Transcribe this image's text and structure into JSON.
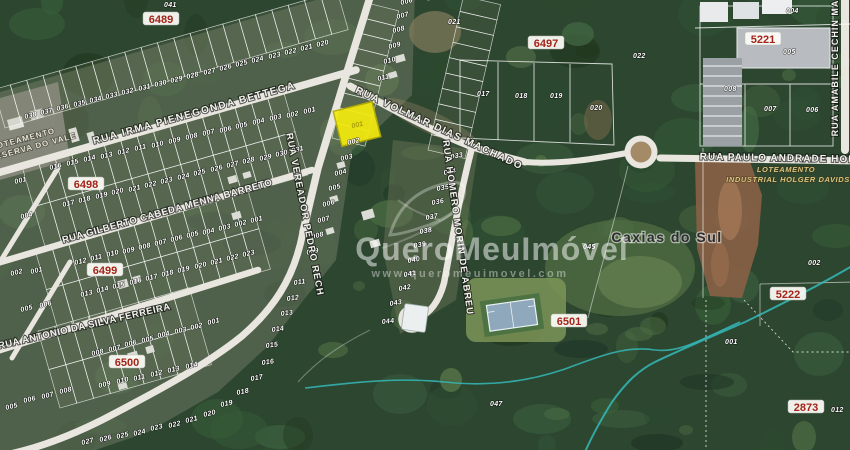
{
  "map": {
    "city_label": "Caxias do Sul",
    "watermark": {
      "brand": "QueroMeuImóvel",
      "url": "www.queromeuimovel.com"
    },
    "colors": {
      "highlight": "#f3ea0e",
      "road": "#e8e6df",
      "stream": "#35b8b8",
      "badge_text": "#a3241a",
      "forest_base": "#2d4630"
    },
    "areas": {
      "left_line1": "LOTEAMENTO",
      "left_line2": "RESERVA DO VALE",
      "right_line1": "LOTEAMENTO",
      "right_line2": "INDUSTRIAL HOLGER DAVIDS"
    },
    "highlight": {
      "lot": "001",
      "x": 357,
      "y": 124
    },
    "streets": [
      {
        "label": "RUA IRMA PIENEGONDA BETTEGA",
        "x": 195,
        "y": 116,
        "r": -15.5,
        "fs": 10,
        "ls": 1.5
      },
      {
        "label": "RUA VOLMAR DIAS MACHADO",
        "x": 438,
        "y": 131,
        "r": 25,
        "fs": 10,
        "ls": 1.5
      },
      {
        "label": "RUA VEREADOR PEDRO RECH",
        "x": 302,
        "y": 215,
        "r": 79,
        "fs": 9.5,
        "ls": 1
      },
      {
        "label": "RUA HOMERO MORIN DE ABREU",
        "x": 455,
        "y": 228,
        "r": 82,
        "fs": 9.5,
        "ls": 1
      },
      {
        "label": "RUA GILBERTO CABEDA MENNA BARRETO",
        "x": 168,
        "y": 214,
        "r": -15.5,
        "fs": 9.5,
        "ls": 0.5
      },
      {
        "label": "RUA ANTONIO DA SILVA FERREIRA",
        "x": 85,
        "y": 329,
        "r": -13,
        "fs": 9.5,
        "ls": 0.5
      },
      {
        "label": "RUA PAULO ANDRADE HON",
        "x": 778,
        "y": 161,
        "r": 1,
        "fs": 10,
        "ls": 1
      },
      {
        "label": "RUA AMABILE CECHIN MA",
        "x": 838,
        "y": 68,
        "r": -90,
        "fs": 9,
        "ls": 1
      }
    ],
    "blocks": [
      {
        "label": "6489",
        "x": 161,
        "y": 22
      },
      {
        "label": "6497",
        "x": 546,
        "y": 46
      },
      {
        "label": "5221",
        "x": 763,
        "y": 42
      },
      {
        "label": "6498",
        "x": 86,
        "y": 187
      },
      {
        "label": "6499",
        "x": 105,
        "y": 273
      },
      {
        "label": "6500",
        "x": 127,
        "y": 365
      },
      {
        "label": "6501",
        "x": 569,
        "y": 324
      },
      {
        "label": "5222",
        "x": 788,
        "y": 297
      },
      {
        "label": "2873",
        "x": 806,
        "y": 410
      }
    ],
    "lot_labels": [
      {
        "t": "041",
        "x": 164,
        "y": 7,
        "r": 0
      },
      {
        "t": "038",
        "x": 25,
        "y": 119
      },
      {
        "t": "037",
        "x": 41,
        "y": 115
      },
      {
        "t": "036",
        "x": 57,
        "y": 111
      },
      {
        "t": "035",
        "x": 74,
        "y": 107
      },
      {
        "t": "034",
        "x": 90,
        "y": 103
      },
      {
        "t": "033",
        "x": 106,
        "y": 99
      },
      {
        "t": "032",
        "x": 122,
        "y": 95
      },
      {
        "t": "031",
        "x": 139,
        "y": 91
      },
      {
        "t": "030",
        "x": 155,
        "y": 87
      },
      {
        "t": "029",
        "x": 171,
        "y": 83
      },
      {
        "t": "028",
        "x": 187,
        "y": 79
      },
      {
        "t": "027",
        "x": 204,
        "y": 75
      },
      {
        "t": "026",
        "x": 220,
        "y": 71
      },
      {
        "t": "025",
        "x": 236,
        "y": 67
      },
      {
        "t": "024",
        "x": 252,
        "y": 63
      },
      {
        "t": "023",
        "x": 269,
        "y": 59
      },
      {
        "t": "022",
        "x": 285,
        "y": 55
      },
      {
        "t": "021",
        "x": 301,
        "y": 51
      },
      {
        "t": "020",
        "x": 317,
        "y": 47
      },
      {
        "t": "001",
        "x": 304,
        "y": 114
      },
      {
        "t": "002",
        "x": 287,
        "y": 118
      },
      {
        "t": "003",
        "x": 270,
        "y": 121
      },
      {
        "t": "004",
        "x": 253,
        "y": 125
      },
      {
        "t": "005",
        "x": 236,
        "y": 129
      },
      {
        "t": "006",
        "x": 220,
        "y": 133
      },
      {
        "t": "007",
        "x": 203,
        "y": 136
      },
      {
        "t": "008",
        "x": 186,
        "y": 140
      },
      {
        "t": "009",
        "x": 169,
        "y": 144
      },
      {
        "t": "010",
        "x": 152,
        "y": 148
      },
      {
        "t": "011",
        "x": 135,
        "y": 151
      },
      {
        "t": "012",
        "x": 118,
        "y": 155
      },
      {
        "t": "013",
        "x": 101,
        "y": 159
      },
      {
        "t": "014",
        "x": 84,
        "y": 162
      },
      {
        "t": "015",
        "x": 67,
        "y": 166
      },
      {
        "t": "016",
        "x": 50,
        "y": 170
      },
      {
        "t": "017",
        "x": 63,
        "y": 207
      },
      {
        "t": "018",
        "x": 79,
        "y": 203
      },
      {
        "t": "019",
        "x": 96,
        "y": 199
      },
      {
        "t": "020",
        "x": 112,
        "y": 195
      },
      {
        "t": "021",
        "x": 129,
        "y": 192
      },
      {
        "t": "022",
        "x": 145,
        "y": 188
      },
      {
        "t": "023",
        "x": 161,
        "y": 184
      },
      {
        "t": "024",
        "x": 178,
        "y": 180
      },
      {
        "t": "025",
        "x": 194,
        "y": 176
      },
      {
        "t": "026",
        "x": 211,
        "y": 172
      },
      {
        "t": "027",
        "x": 227,
        "y": 168
      },
      {
        "t": "028",
        "x": 243,
        "y": 164
      },
      {
        "t": "029",
        "x": 260,
        "y": 161
      },
      {
        "t": "030",
        "x": 276,
        "y": 157
      },
      {
        "t": "031",
        "x": 292,
        "y": 153
      },
      {
        "t": "012",
        "x": 75,
        "y": 265
      },
      {
        "t": "011",
        "x": 91,
        "y": 261
      },
      {
        "t": "010",
        "x": 107,
        "y": 257
      },
      {
        "t": "009",
        "x": 123,
        "y": 254
      },
      {
        "t": "008",
        "x": 139,
        "y": 250
      },
      {
        "t": "007",
        "x": 155,
        "y": 246
      },
      {
        "t": "006",
        "x": 171,
        "y": 242
      },
      {
        "t": "005",
        "x": 187,
        "y": 238
      },
      {
        "t": "004",
        "x": 203,
        "y": 235
      },
      {
        "t": "003",
        "x": 219,
        "y": 231
      },
      {
        "t": "002",
        "x": 235,
        "y": 227
      },
      {
        "t": "001",
        "x": 251,
        "y": 223
      },
      {
        "t": "013",
        "x": 81,
        "y": 297
      },
      {
        "t": "014",
        "x": 97,
        "y": 293
      },
      {
        "t": "015",
        "x": 113,
        "y": 289
      },
      {
        "t": "016",
        "x": 130,
        "y": 285
      },
      {
        "t": "017",
        "x": 146,
        "y": 281
      },
      {
        "t": "018",
        "x": 162,
        "y": 277
      },
      {
        "t": "019",
        "x": 178,
        "y": 273
      },
      {
        "t": "020",
        "x": 195,
        "y": 269
      },
      {
        "t": "021",
        "x": 211,
        "y": 265
      },
      {
        "t": "022",
        "x": 227,
        "y": 261
      },
      {
        "t": "023",
        "x": 243,
        "y": 257
      },
      {
        "t": "008",
        "x": 92,
        "y": 356
      },
      {
        "t": "007",
        "x": 109,
        "y": 352
      },
      {
        "t": "006",
        "x": 125,
        "y": 347
      },
      {
        "t": "005",
        "x": 142,
        "y": 343
      },
      {
        "t": "004",
        "x": 158,
        "y": 338
      },
      {
        "t": "003",
        "x": 175,
        "y": 334
      },
      {
        "t": "002",
        "x": 191,
        "y": 330
      },
      {
        "t": "001",
        "x": 208,
        "y": 325
      },
      {
        "t": "009",
        "x": 99,
        "y": 388
      },
      {
        "t": "010",
        "x": 117,
        "y": 384
      },
      {
        "t": "011",
        "x": 134,
        "y": 381
      },
      {
        "t": "012",
        "x": 151,
        "y": 377
      },
      {
        "t": "013",
        "x": 168,
        "y": 373
      },
      {
        "t": "014",
        "x": 186,
        "y": 369
      },
      {
        "t": "005",
        "x": 6,
        "y": 410
      },
      {
        "t": "006",
        "x": 24,
        "y": 403
      },
      {
        "t": "007",
        "x": 42,
        "y": 399
      },
      {
        "t": "008",
        "x": 60,
        "y": 394
      },
      {
        "t": "011",
        "x": 294,
        "y": 285,
        "r": -8
      },
      {
        "t": "012",
        "x": 287,
        "y": 301,
        "r": -8
      },
      {
        "t": "013",
        "x": 281,
        "y": 316,
        "r": -8
      },
      {
        "t": "014",
        "x": 272,
        "y": 332,
        "r": -8
      },
      {
        "t": "015",
        "x": 266,
        "y": 348,
        "r": -8
      },
      {
        "t": "016",
        "x": 262,
        "y": 365,
        "r": -8
      },
      {
        "t": "017",
        "x": 251,
        "y": 381,
        "r": -10
      },
      {
        "t": "018",
        "x": 237,
        "y": 395,
        "r": -12
      },
      {
        "t": "019",
        "x": 221,
        "y": 407,
        "r": -13
      },
      {
        "t": "020",
        "x": 204,
        "y": 417,
        "r": -14
      },
      {
        "t": "021",
        "x": 186,
        "y": 423,
        "r": -14
      },
      {
        "t": "022",
        "x": 169,
        "y": 428,
        "r": -14
      },
      {
        "t": "023",
        "x": 151,
        "y": 431,
        "r": -14
      },
      {
        "t": "024",
        "x": 134,
        "y": 436,
        "r": -14
      },
      {
        "t": "025",
        "x": 117,
        "y": 439,
        "r": -14
      },
      {
        "t": "026",
        "x": 100,
        "y": 442,
        "r": -14
      },
      {
        "t": "027",
        "x": 82,
        "y": 445,
        "r": -14
      },
      {
        "t": "001",
        "x": 15,
        "y": 184
      },
      {
        "t": "004",
        "x": 21,
        "y": 219
      },
      {
        "t": "002",
        "x": 11,
        "y": 276
      },
      {
        "t": "001",
        "x": 31,
        "y": 274
      },
      {
        "t": "005",
        "x": 21,
        "y": 312
      },
      {
        "t": "006",
        "x": 40,
        "y": 308
      },
      {
        "t": "006",
        "x": 401,
        "y": 5
      },
      {
        "t": "007",
        "x": 397,
        "y": 19
      },
      {
        "t": "008",
        "x": 393,
        "y": 33
      },
      {
        "t": "009",
        "x": 389,
        "y": 49
      },
      {
        "t": "010",
        "x": 384,
        "y": 64
      },
      {
        "t": "011",
        "x": 378,
        "y": 81
      },
      {
        "t": "021",
        "x": 448,
        "y": 24,
        "r": 0
      },
      {
        "t": "002",
        "x": 348,
        "y": 145
      },
      {
        "t": "003",
        "x": 341,
        "y": 161
      },
      {
        "t": "004",
        "x": 335,
        "y": 176
      },
      {
        "t": "005",
        "x": 329,
        "y": 191
      },
      {
        "t": "006",
        "x": 323,
        "y": 207
      },
      {
        "t": "007",
        "x": 318,
        "y": 223
      },
      {
        "t": "008",
        "x": 312,
        "y": 239
      },
      {
        "t": "009",
        "x": 307,
        "y": 255
      },
      {
        "t": "033",
        "x": 451,
        "y": 159,
        "r": -10
      },
      {
        "t": "034",
        "x": 444,
        "y": 175,
        "r": -10
      },
      {
        "t": "035",
        "x": 437,
        "y": 191,
        "r": -10
      },
      {
        "t": "036",
        "x": 432,
        "y": 205,
        "r": -10
      },
      {
        "t": "037",
        "x": 426,
        "y": 220,
        "r": -10
      },
      {
        "t": "038",
        "x": 420,
        "y": 234,
        "r": -10
      },
      {
        "t": "039",
        "x": 414,
        "y": 248,
        "r": -10
      },
      {
        "t": "040",
        "x": 408,
        "y": 263,
        "r": -10
      },
      {
        "t": "041",
        "x": 404,
        "y": 277,
        "r": -10
      },
      {
        "t": "042",
        "x": 399,
        "y": 291,
        "r": -10
      },
      {
        "t": "043",
        "x": 390,
        "y": 306,
        "r": -10
      },
      {
        "t": "044",
        "x": 382,
        "y": 324,
        "r": -6
      },
      {
        "t": "017",
        "x": 477,
        "y": 96,
        "r": 0
      },
      {
        "t": "018",
        "x": 515,
        "y": 98,
        "r": 0
      },
      {
        "t": "019",
        "x": 550,
        "y": 98,
        "r": 0
      },
      {
        "t": "020",
        "x": 590,
        "y": 110,
        "r": 0
      },
      {
        "t": "004",
        "x": 786,
        "y": 13,
        "r": 0
      },
      {
        "t": "005",
        "x": 783,
        "y": 54,
        "r": 0
      },
      {
        "t": "008",
        "x": 724,
        "y": 91,
        "r": 0
      },
      {
        "t": "007",
        "x": 764,
        "y": 111,
        "r": 0
      },
      {
        "t": "006",
        "x": 806,
        "y": 112,
        "r": 0
      },
      {
        "t": "022",
        "x": 633,
        "y": 58,
        "r": 0
      },
      {
        "t": "045",
        "x": 583,
        "y": 249,
        "r": 0
      },
      {
        "t": "002",
        "x": 808,
        "y": 265,
        "r": 0
      },
      {
        "t": "001",
        "x": 725,
        "y": 344,
        "r": 0
      },
      {
        "t": "047",
        "x": 490,
        "y": 406,
        "r": 0
      },
      {
        "t": "012",
        "x": 831,
        "y": 412,
        "r": 0
      }
    ]
  }
}
